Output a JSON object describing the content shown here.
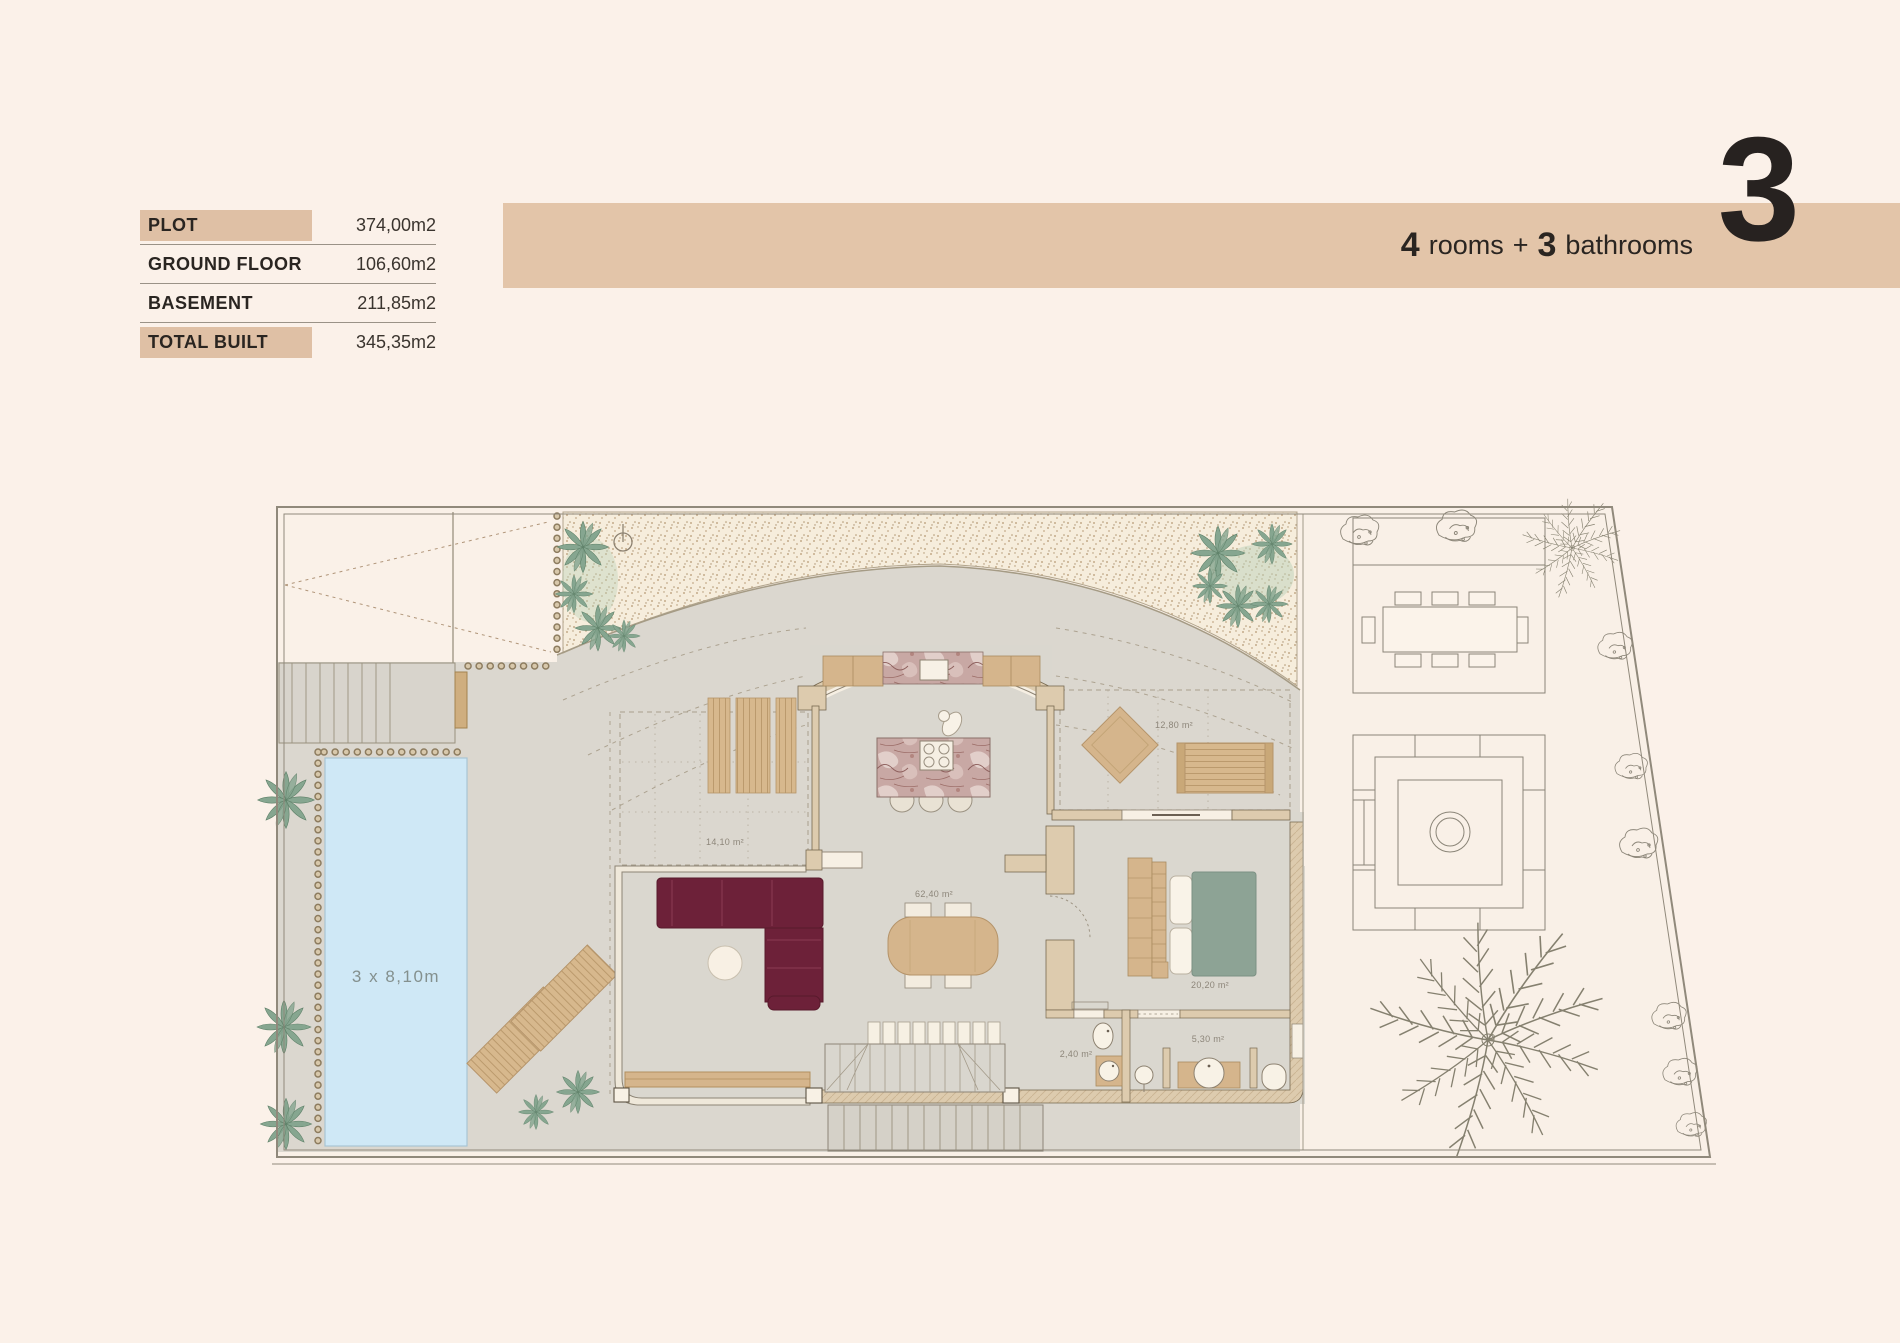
{
  "spec_table": {
    "rows": [
      {
        "label": "PLOT",
        "value": "374,00m2",
        "highlight": true
      },
      {
        "label": "GROUND FLOOR",
        "value": "106,60m2",
        "highlight": false
      },
      {
        "label": "BASEMENT",
        "value": "211,85m2",
        "highlight": false
      },
      {
        "label": "TOTAL BUILT",
        "value": "345,35m2",
        "highlight": true
      }
    ]
  },
  "banner": {
    "rooms_count": "4",
    "rooms_word": "rooms",
    "plus": "+",
    "bath_count": "3",
    "bath_word": "bathrooms",
    "floor_number": "3"
  },
  "plan": {
    "pool_label": "3 x 8,10m",
    "areas": {
      "covered_terrace": "14,10 m²",
      "living_room": "62,40 m²",
      "side_terrace": "12,80 m²",
      "bedroom": "20,20 m²",
      "wc": "2,40 m²",
      "bathroom": "5,30 m²"
    },
    "colors": {
      "background": "#fbf1e9",
      "banner": "#e3c5a9",
      "table_highlight": "#dfc0a5",
      "terrace": "#dbd7cf",
      "pool": "#cfe8f6",
      "sofa": "#6d2139",
      "bed": "#8da395",
      "wood": "#d5b58c",
      "wall": "#ddcbae",
      "marble": "#c8a8a4",
      "plant_green": "#86a690",
      "gravel": "#f6eddc"
    }
  }
}
